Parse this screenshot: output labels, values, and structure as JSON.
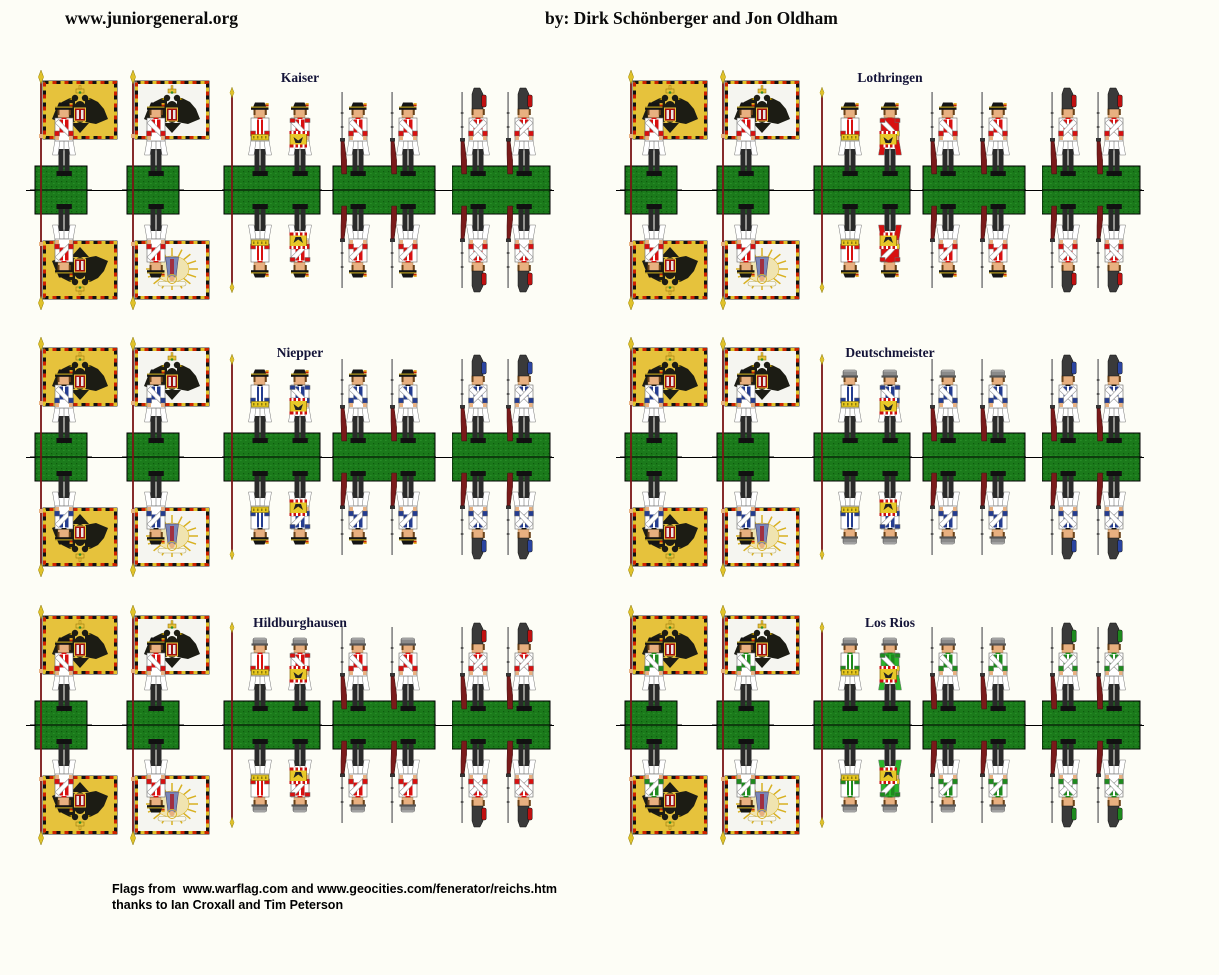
{
  "header": {
    "site": "www.juniorgeneral.org",
    "byline": "by: Dirk Schönberger and Jon Oldham"
  },
  "footer": {
    "line1": "Flags from  www.warflag.com and www.geocities.com/fenerator/reichs.htm",
    "line2": "thanks to Ian Croxall and Tim Peterson"
  },
  "regiments": [
    {
      "name": "Kaiser",
      "col": 0,
      "row": 0,
      "facing": "#d81010",
      "hat": "tricorn",
      "grenadier_bag": "#c01010",
      "drummer_coat": "#ffffff"
    },
    {
      "name": "Lothringen",
      "col": 1,
      "row": 0,
      "facing": "#d81010",
      "hat": "tricorn",
      "grenadier_bag": "#c01010",
      "drummer_coat": "#d81010"
    },
    {
      "name": "Niepper",
      "col": 0,
      "row": 1,
      "facing": "#243c90",
      "hat": "tricorn",
      "grenadier_bag": "#2a44a0",
      "drummer_coat": "#ffffff"
    },
    {
      "name": "Deutschmeister",
      "col": 1,
      "row": 1,
      "facing": "#243c90",
      "hat": "cap",
      "grenadier_bag": "#2a44a0",
      "drummer_coat": "#ffffff"
    },
    {
      "name": "Hildburghausen",
      "col": 0,
      "row": 2,
      "facing": "#d81010",
      "hat": "cap",
      "grenadier_bag": "#c01010",
      "drummer_coat": "#ffffff"
    },
    {
      "name": "Los Rios",
      "col": 1,
      "row": 2,
      "facing": "#1e8a1e",
      "hat": "cap",
      "grenadier_bag": "#1e8a1e",
      "drummer_coat": "#2ab52a"
    }
  ],
  "colors": {
    "page_bg": "#fdfdf6",
    "base_green": "#1b7a1b",
    "base_speckle_dark": "#0e5a0e",
    "base_speckle_light": "#2f9a2f",
    "pole": "#7a1616",
    "finial_gold": "#e0c22a",
    "coat_white": "#ffffff",
    "outline": "#777777",
    "flesh": "#e8b080",
    "hair": "#6a4218",
    "black": "#141414",
    "tricorn_gold": "#d8b820",
    "cap_gray": "#8a8a8a",
    "cap_brim": "#555555",
    "gren_cap": "#3a3a3a",
    "musket_barrel": "#909090",
    "musket_stock": "#7a1a1a",
    "gaiter": "#2a2a2a",
    "shoe": "#111111",
    "sash": "#e8c820",
    "drum_shell": "#e8c828",
    "drum_rim": "#cc1111",
    "flag_yellow": "#e6c23c",
    "flag_white": "#f5f5f0",
    "flag_border_red": "#cc2200",
    "eagle_black": "#1c1c14",
    "shield_red": "#a01010",
    "ray_gold": "#d8b020",
    "glow": "#f0e4b0",
    "madonna_robe": "#7a86b8",
    "madonna_inner": "#a03040"
  },
  "layout": {
    "col_x": [
      30,
      620
    ],
    "row_mid": [
      190,
      457,
      725
    ],
    "strip_dx": {
      "flag1": 0,
      "flag2": 92,
      "command": 192,
      "musket": 302,
      "gren": 422
    },
    "label_dx": 270,
    "label_dy": [
      -120,
      -112,
      -110
    ],
    "header_site_pos": [
      65,
      8
    ],
    "header_byline_pos": [
      545,
      8
    ],
    "credits_pos": [
      112,
      881
    ]
  }
}
